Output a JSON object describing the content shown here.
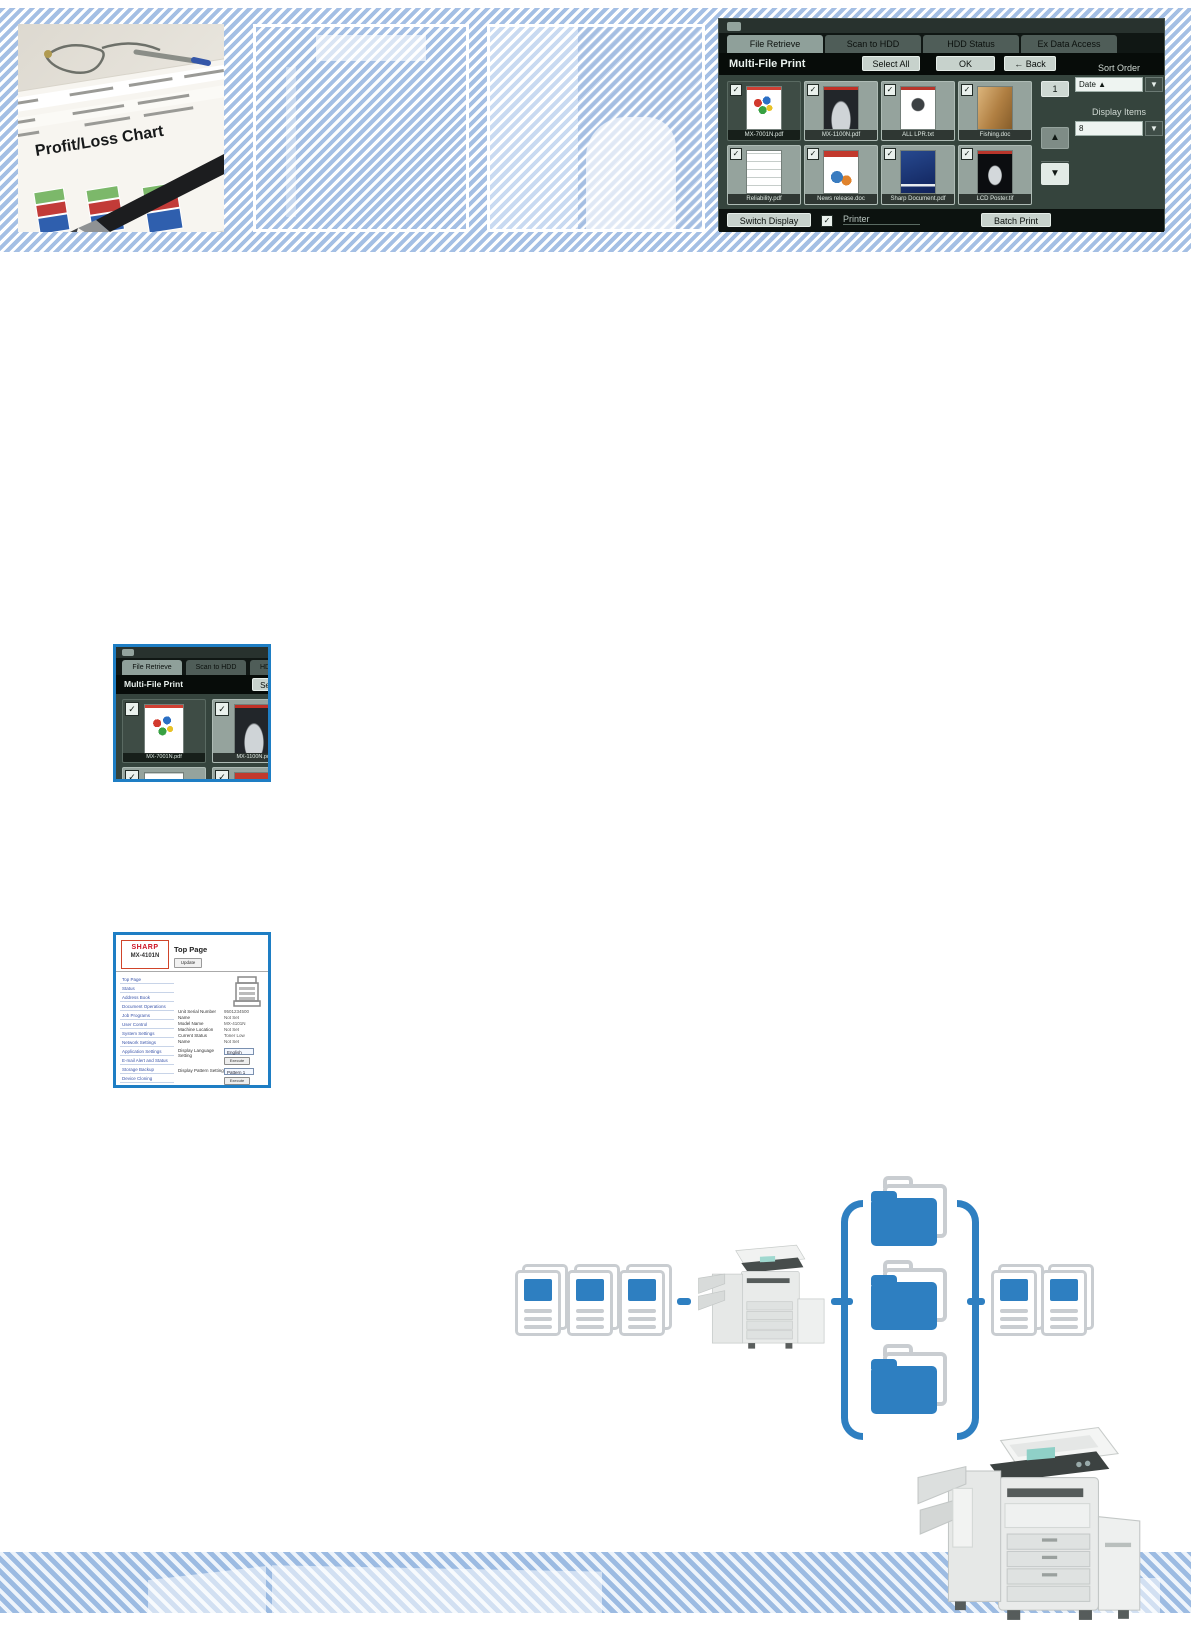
{
  "photo": {
    "caption": "Profit/Loss Chart"
  },
  "mfp": {
    "tabs": [
      "File Retrieve",
      "Scan to HDD",
      "HDD Status",
      "Ex Data Access"
    ],
    "title": "Multi-File Print",
    "select_all": "Select All",
    "ok": "OK",
    "back": "Back",
    "back_arrow": "←",
    "files": [
      {
        "name": "MX-7001N.pdf"
      },
      {
        "name": "MX-1100N.pdf"
      },
      {
        "name": "ALL LPR.txt"
      },
      {
        "name": "Fishing.doc"
      },
      {
        "name": "Reliability.pdf"
      },
      {
        "name": "News release.doc"
      },
      {
        "name": "Sharp Document.pdf"
      },
      {
        "name": "LCD Poster.tif"
      }
    ],
    "page_current": "1",
    "page_next": "2",
    "up_arrow": "▲",
    "down_arrow": "▼",
    "sort_order_label": "Sort Order",
    "sort_order_value": "Date ▲",
    "display_items_label": "Display Items",
    "display_items_value": "8",
    "dropdown_arrow": "▼",
    "switch_display": "Switch Display",
    "printer": "Printer",
    "batch_print": "Batch Print",
    "check": "✓"
  },
  "crop": {
    "tab3_fragment": "HD",
    "select_fragment": "Se"
  },
  "web": {
    "brand": "SHARP",
    "model": "MX-4101N",
    "title": "Top Page",
    "update": "Update",
    "sidebar": [
      "Top Page",
      "Status",
      "Address Book",
      "Document Operations",
      "Job Programs",
      "User Control",
      "System Settings",
      "Network Settings",
      "Application Settings",
      "E-mail Alert and Status",
      "Storage Backup",
      "Device Cloning",
      "Job Log",
      "Security Settings"
    ],
    "fields": [
      {
        "label": "Unit Serial Number",
        "value": "9501234500"
      },
      {
        "label": "Name",
        "value": "Not Set"
      },
      {
        "label": "Model Name",
        "value": "MX-4101N"
      },
      {
        "label": "Machine Location",
        "value": "Not Set"
      },
      {
        "label": "Current Status",
        "value": "Toner Low"
      },
      {
        "label": "Name",
        "value": "Not Set"
      }
    ],
    "language_label": "Display Language Setting",
    "language_value": "English",
    "execute": "Execute",
    "pattern_label": "Display Pattern Setting",
    "pattern_value": "Pattern 1"
  }
}
